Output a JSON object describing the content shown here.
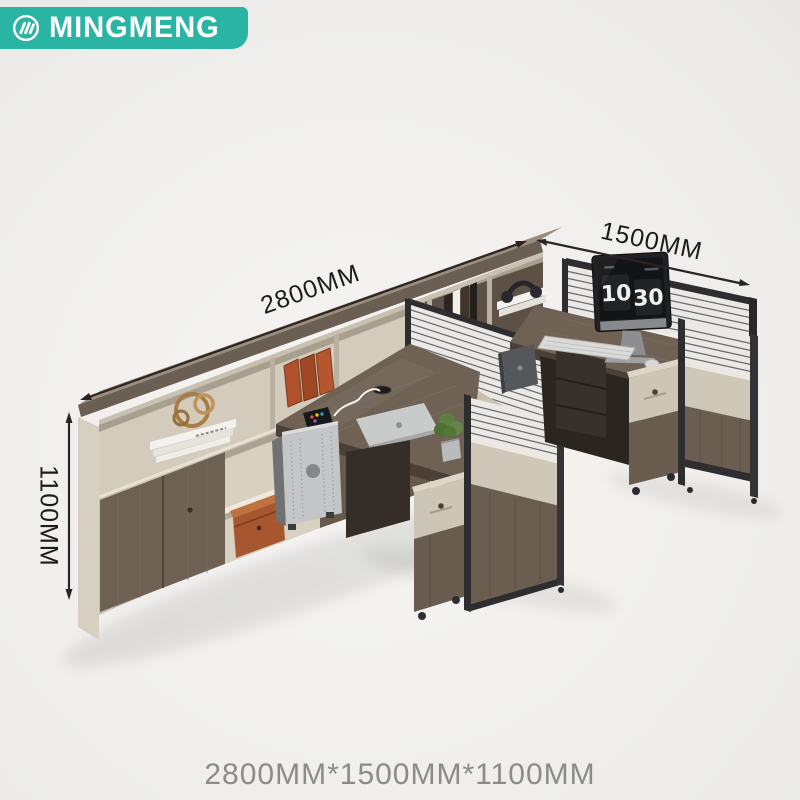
{
  "brand": {
    "name": "MINGMENG",
    "icon": "mingmeng-monogram-icon",
    "banner_color": "#2AB4A3"
  },
  "annotations": {
    "length_label": "2800MM",
    "depth_label": "1500MM",
    "height_label": "1100MM"
  },
  "footer": {
    "size_summary": "2800MM*1500MM*1100MM"
  },
  "screen_clock": {
    "hours": "10",
    "minutes": "30"
  },
  "colors": {
    "background": "#F0EFED",
    "dimension_line": "#2B2422",
    "dimension_text": "#1D1B1A",
    "summary_text": "#8B8B8B",
    "wood_top": "#9A8D7E",
    "wood_front": "#6C5F53",
    "wood_dark": "#4A4036",
    "beige_light": "#D7CFC0",
    "beige_mid": "#C8C0B1",
    "panel_beige": "#CFC7B8",
    "frame_dark": "#2E2D2F",
    "stripe_panel": "#EAE9E5",
    "stripe_line": "#54555A",
    "metal_silver": "#C3C5C7",
    "accent_orange": "#B0512B",
    "leather_box": "#A65730",
    "plant_green": "#5D8040",
    "screen_black": "#131416"
  }
}
